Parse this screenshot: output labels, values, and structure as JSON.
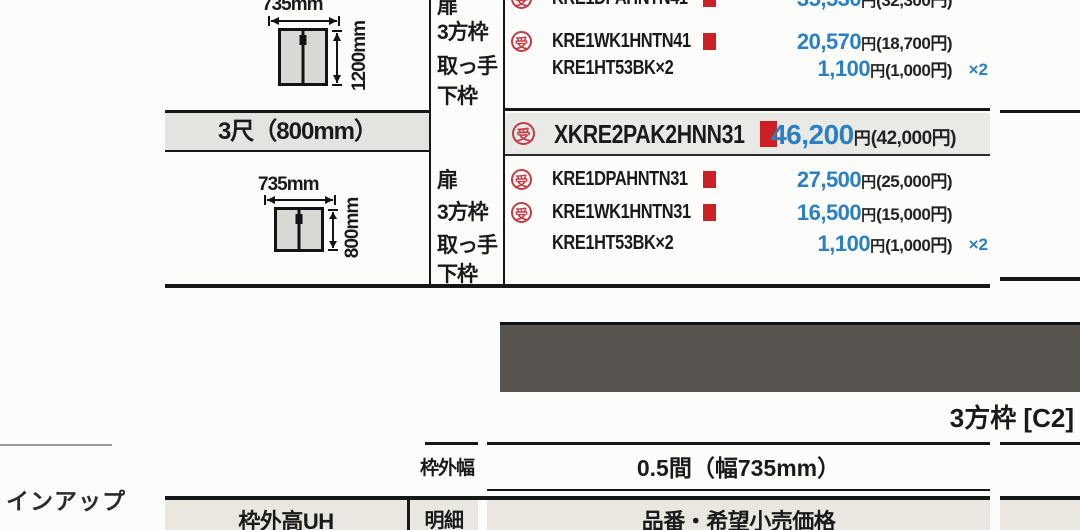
{
  "stamp_char": "受",
  "upper_section": {
    "diagram": {
      "width_label": "735mm",
      "height_label": "1200mm"
    },
    "item_labels": [
      "扉",
      "3方枠",
      "取っ手",
      "下枠"
    ],
    "rows": [
      {
        "part": "KRE1DPAHNTN41",
        "price": "35,530",
        "unit": "円",
        "paren": "(32,300円)"
      },
      {
        "part": "KRE1WK1HNTN41",
        "price": "20,570",
        "unit": "円",
        "paren": "(18,700円)"
      },
      {
        "part": "KRE1HT53BK×2",
        "price": "1,100",
        "unit": "円",
        "paren": "(1,000円)",
        "multiplier": "×2"
      }
    ]
  },
  "size_band": {
    "label": "3尺（800mm）"
  },
  "featured_row": {
    "part": "XKRE2PAK2HNN31",
    "price": "46,200",
    "unit": "円",
    "paren": "(42,000円)"
  },
  "lower_section": {
    "diagram": {
      "width_label": "735mm",
      "height_label": "800mm"
    },
    "item_labels": [
      "扉",
      "3方枠",
      "取っ手",
      "下枠"
    ],
    "rows": [
      {
        "part": "KRE1DPAHNTN31",
        "price": "27,500",
        "unit": "円",
        "paren": "(25,000円)"
      },
      {
        "part": "KRE1WK1HNTN31",
        "price": "16,500",
        "unit": "円",
        "paren": "(15,000円)"
      },
      {
        "part": "KRE1HT53BK×2",
        "price": "1,100",
        "unit": "円",
        "paren": "(1,000円)",
        "multiplier": "×2"
      }
    ]
  },
  "section_caption": "3方枠 [C2]",
  "spec_table": {
    "width_row_label": "枠外幅",
    "width_row_value": "0.5間（幅735mm）",
    "height_header": "枠外高UH",
    "detail_header": "明細",
    "price_header": "品番・希望小売価格"
  },
  "lineup_label": "インアップ",
  "colors": {
    "price_blue": "#2b80c4",
    "stamp_red": "#c23a44",
    "marker_red": "#cd2026",
    "dark_banner": "#57534f",
    "band_gray": "#e3e3e0",
    "header_gray": "#e9e7e0"
  }
}
